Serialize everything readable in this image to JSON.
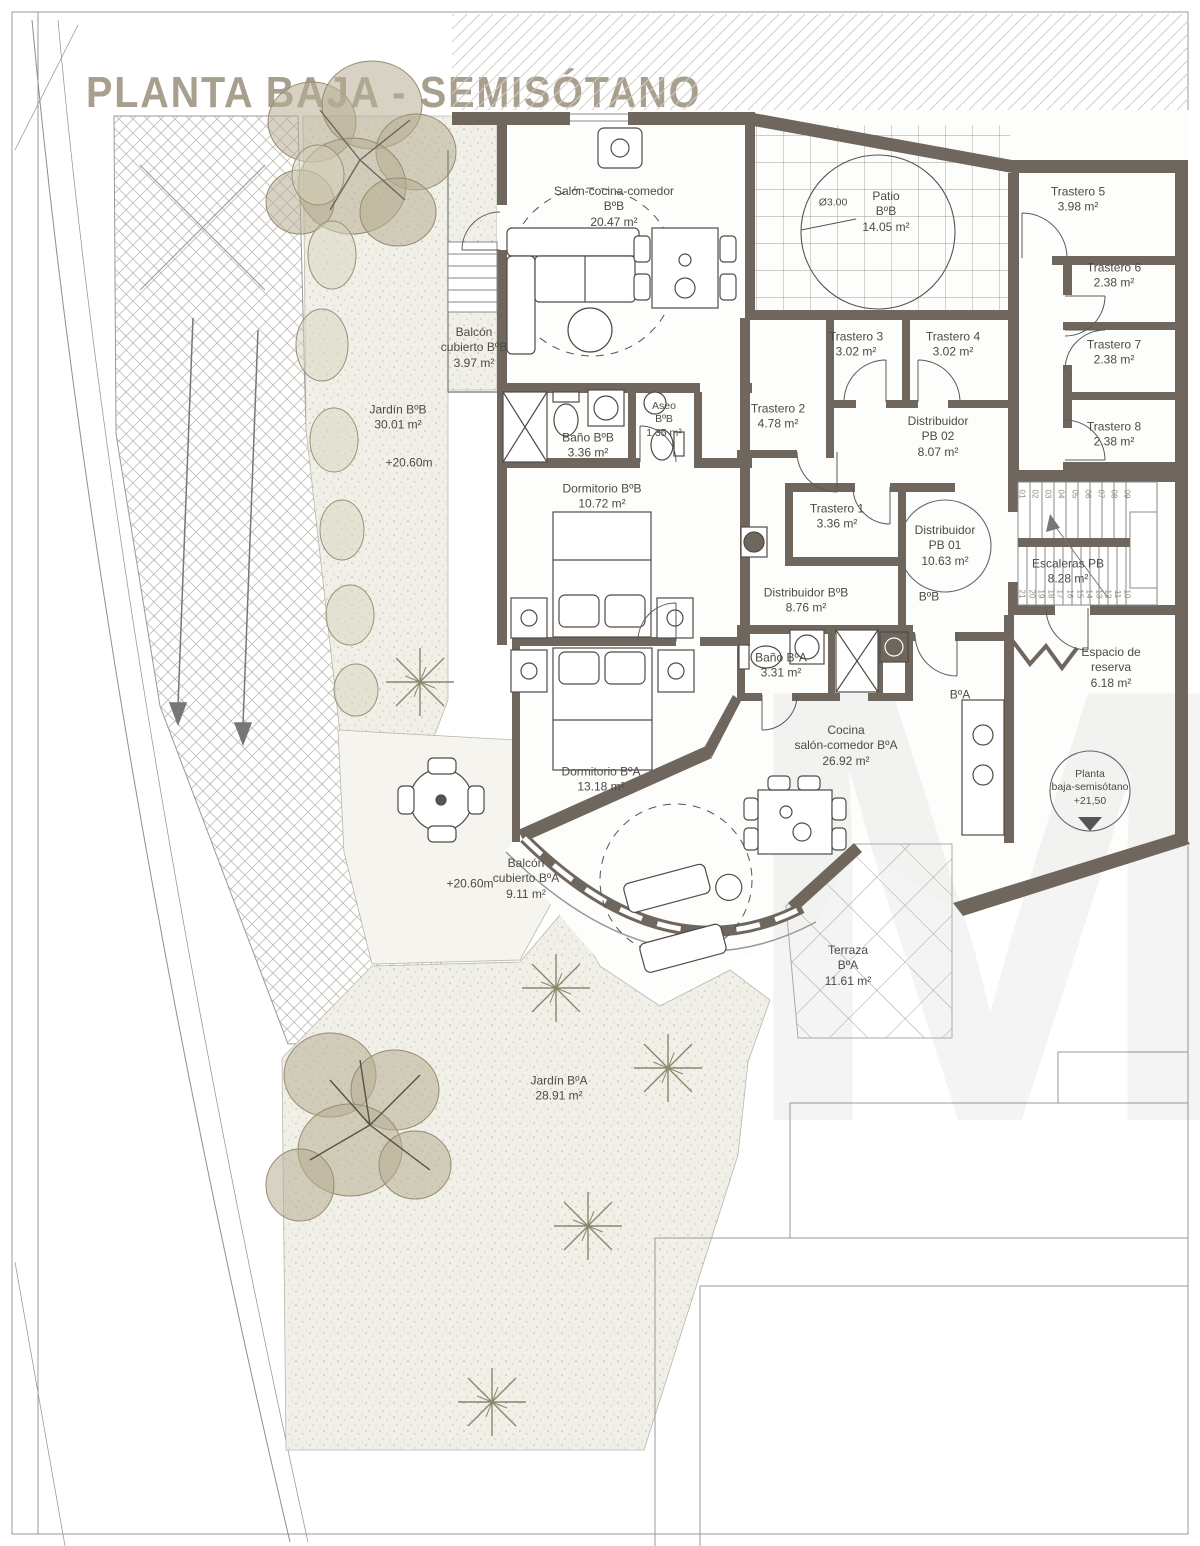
{
  "title": "PLANTA BAJA - SEMISÓTANO",
  "watermark": "M",
  "colors": {
    "wall": "#6f675e",
    "title_text": "#a89f8f",
    "label_text": "#4e4a45",
    "plant": "#b3a98e"
  },
  "rooms": {
    "salon_bb": {
      "lines": [
        "Salón-cocina-comedor",
        "BºB",
        "20.47 m²"
      ]
    },
    "balcon_bb": {
      "lines": [
        "Balcón",
        "cubierto BºB",
        "3.97 m²"
      ]
    },
    "jardin_bb": {
      "lines": [
        "Jardín BºB",
        "30.01 m²"
      ]
    },
    "jardin_bb_level": {
      "lines": [
        "+20.60m"
      ]
    },
    "patio": {
      "lines": [
        "Patio",
        "BºB",
        "14.05 m²"
      ]
    },
    "patio_diameter": {
      "lines": [
        "Ø3.00"
      ]
    },
    "trastero5": {
      "lines": [
        "Trastero 5",
        "3.98 m²"
      ]
    },
    "trastero6": {
      "lines": [
        "Trastero 6",
        "2.38 m²"
      ]
    },
    "trastero7": {
      "lines": [
        "Trastero 7",
        "2.38 m²"
      ]
    },
    "trastero8": {
      "lines": [
        "Trastero 8",
        "2.38 m²"
      ]
    },
    "trastero3": {
      "lines": [
        "Trastero 3",
        "3.02 m²"
      ]
    },
    "trastero4": {
      "lines": [
        "Trastero 4",
        "3.02 m²"
      ]
    },
    "trastero2": {
      "lines": [
        "Trastero 2",
        "4.78 m²"
      ]
    },
    "dist_pb02": {
      "lines": [
        "Distribuidor",
        "PB 02",
        "8.07 m²"
      ]
    },
    "trastero1": {
      "lines": [
        "Trastero 1",
        "3.36 m²"
      ]
    },
    "dist_pb01": {
      "lines": [
        "Distribuidor",
        "PB 01",
        "10.63 m²"
      ]
    },
    "escaleras": {
      "lines": [
        "Escaleras PB",
        "8.28 m²"
      ]
    },
    "dist_bb": {
      "lines": [
        "Distribuidor BºB",
        "8.76 m²"
      ]
    },
    "unit_bb": {
      "lines": [
        "BºB"
      ]
    },
    "bano_bb": {
      "lines": [
        "Baño BºB",
        "3.36 m²"
      ]
    },
    "aseo_bb": {
      "lines": [
        "Aseo",
        "BºB",
        "1.35 m²"
      ]
    },
    "dorm_bb": {
      "lines": [
        "Dormitorio BºB",
        "10.72 m²"
      ]
    },
    "bano_ba": {
      "lines": [
        "Baño BºA",
        "3.31 m²"
      ]
    },
    "unit_ba": {
      "lines": [
        "BºA"
      ]
    },
    "espacio": {
      "lines": [
        "Espacio de",
        "reserva",
        "6.18 m²"
      ]
    },
    "cocina_ba": {
      "lines": [
        "Cocina",
        "salón-comedor BºA",
        "26.92 m²"
      ]
    },
    "dorm_ba": {
      "lines": [
        "Dormitorio BºA",
        "13.18 m²"
      ]
    },
    "planta_baja": {
      "lines": [
        "Planta",
        "baja-semisótano",
        "+21,50"
      ]
    },
    "balcon_ba": {
      "lines": [
        "Balcón",
        "cubierto BºA",
        "9.11 m²"
      ]
    },
    "terraza": {
      "lines": [
        "Terraza",
        "BºA",
        "11.61 m²"
      ]
    },
    "terrace_level": {
      "lines": [
        "+20.60m"
      ]
    },
    "jardin_ba": {
      "lines": [
        "Jardín BºA",
        "28.91 m²"
      ]
    }
  },
  "stairs": {
    "top_steps": [
      "01",
      "02",
      "03",
      "04",
      "05",
      "06",
      "07",
      "08",
      "09"
    ],
    "bottom_steps": [
      "21",
      "20",
      "19",
      "18",
      "17",
      "16",
      "15",
      "14",
      "13",
      "12",
      "11",
      "10"
    ]
  }
}
